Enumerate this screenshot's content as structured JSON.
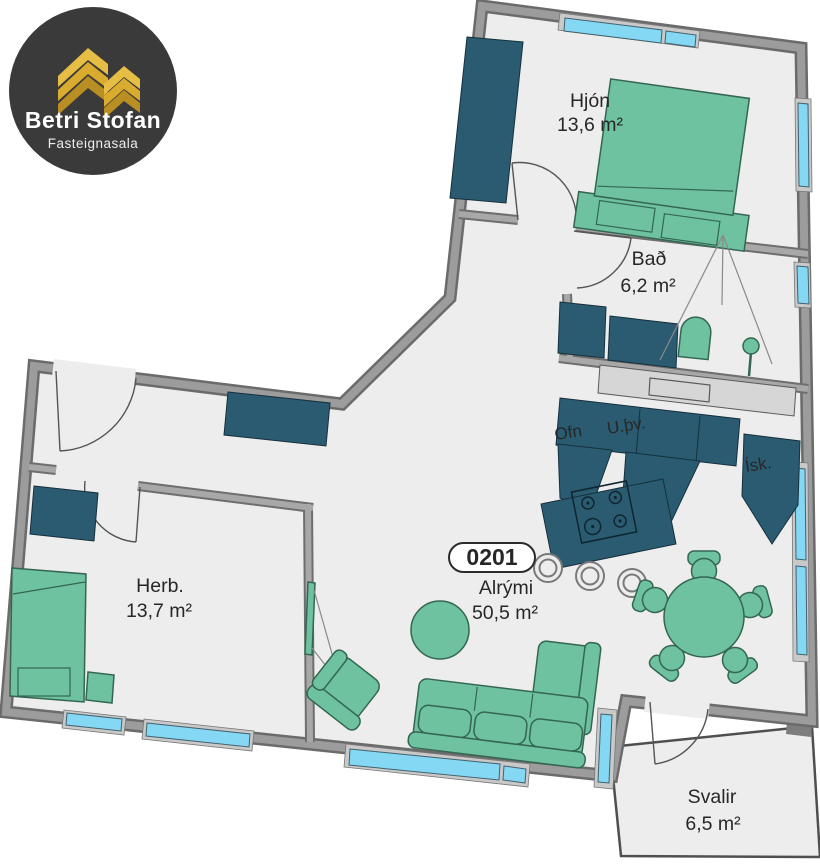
{
  "logo": {
    "brand": "Betri Stofan",
    "tagline": "Fasteignasala"
  },
  "unit": {
    "number": "0201"
  },
  "rooms": {
    "hjon": {
      "name": "Hjón",
      "area": "13,6 m²"
    },
    "bad": {
      "name": "Bað",
      "area": "6,2 m²"
    },
    "alrymi": {
      "name": "Alrými",
      "area": "50,5 m²"
    },
    "herb": {
      "name": "Herb.",
      "area": "13,7 m²"
    },
    "svalir": {
      "name": "Svalir",
      "area": "6,5 m²"
    }
  },
  "kitchen": {
    "oven": "Ofn",
    "dishwasher": "U.þv.",
    "fridge": "Ísk."
  },
  "colors": {
    "furniture_green": "#6fc2a0",
    "furniture_dark_teal": "#2a5b70",
    "wall_gray": "#9c9c9c",
    "window_blue": "#85d8f3",
    "floor": "#ededed",
    "logo_background": "#3a3a3a",
    "logo_gold": "#d9ab2e",
    "text": "#272727"
  }
}
